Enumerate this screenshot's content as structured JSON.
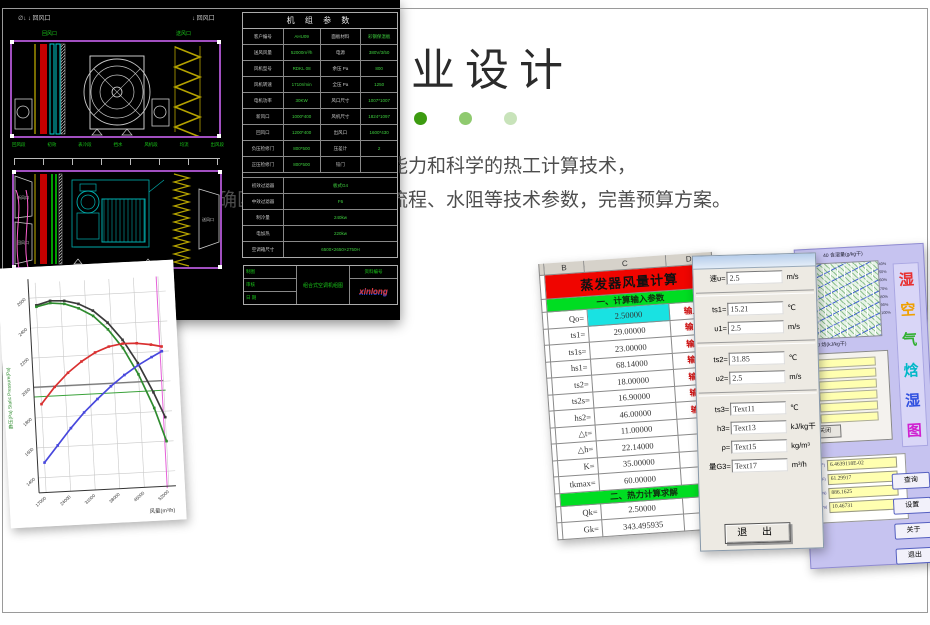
{
  "header": {
    "title": "专业设计",
    "subtitle_line1": "专业的设计能力和科学的热工计算技术，",
    "subtitle_line2": "准确匹配盘管冷热量、流程、水阻等技术参数，完善预算方案。",
    "dot_colors": [
      "#3c9b10",
      "#8fca6f",
      "#c8e3ba"
    ]
  },
  "chart_data": {
    "type": "line",
    "xlabel": "风量(m³/h)",
    "ylabel": "静压(Pa) Static Pressure(Pa)",
    "xlim": [
      15000,
      54000
    ],
    "ylim": [
      1300,
      2700
    ],
    "x_ticks": [
      17000,
      24000,
      31000,
      38000,
      45000,
      52000
    ],
    "y_ticks": [
      1400,
      1600,
      1800,
      2000,
      2200,
      2400,
      2600
    ],
    "x": [
      17000,
      21000,
      25000,
      29000,
      33000,
      37000,
      41000,
      45000,
      49000,
      52000
    ],
    "series": [
      {
        "name": "total-pressure-black",
        "color": "#3a3a3a",
        "values": [
          2550,
          2575,
          2570,
          2545,
          2495,
          2410,
          2290,
          2130,
          1930,
          1760
        ]
      },
      {
        "name": "static-pressure-green",
        "color": "#2e8b2e",
        "values": [
          2540,
          2560,
          2550,
          2515,
          2460,
          2365,
          2235,
          2055,
          1825,
          1600
        ]
      },
      {
        "name": "curve-red",
        "color": "#d93030",
        "values": [
          1890,
          2000,
          2090,
          2160,
          2215,
          2250,
          2265,
          2262,
          2248,
          2232
        ]
      },
      {
        "name": "curve-blue",
        "color": "#4848dd",
        "values": [
          1500,
          1610,
          1720,
          1820,
          1905,
          1985,
          2055,
          2115,
          2165,
          2200
        ]
      }
    ],
    "ref_lines": {
      "gray_y": 2005,
      "green_y": 1940,
      "magenta_x": 51500
    },
    "grid": true,
    "legend": false
  },
  "cad": {
    "top_marks": [
      "∅↓ ↓ 回风口",
      "↓ 回风口"
    ],
    "top_green_labels": [
      "回风口",
      "送风口"
    ],
    "mid_section_labels": [
      "回风段",
      "初效",
      "表冷段",
      "挡水",
      "风机段",
      "均流",
      "出风段"
    ],
    "bottom_section_labels": [
      "表冷挡水段",
      "中效过滤段"
    ],
    "lower_port_labels": {
      "left_top": "新风口",
      "left_bottom": "回风口",
      "right": "送风口"
    },
    "table": {
      "title": "机 组 参 数",
      "rows": [
        [
          "客户编号",
          "AHU09",
          "面板材料",
          "彩钢保温板"
        ],
        [
          "送风风量",
          "52000m³/h",
          "电源",
          "380V/3/50"
        ],
        [
          "风机型号",
          "RDKL 08",
          "余压 Pa",
          "800"
        ],
        [
          "风机转速",
          "1710r/min",
          "全压 Pa",
          "1250"
        ],
        [
          "电机功率",
          "30KW",
          "风口尺寸",
          "1007*1007"
        ],
        [
          "新风口",
          "1000*400",
          "风机尺寸",
          "1824*1097"
        ],
        [
          "回风口",
          "1200*400",
          "出风口",
          "1600*430"
        ],
        [
          "负压检修门",
          "800*500",
          "压差计",
          "2"
        ],
        [
          "正压检修门",
          "800*500",
          "铰门",
          ""
        ],
        [
          "初效过滤器",
          "板式G4"
        ],
        [
          "中效过滤器",
          "F6"
        ],
        [
          "制冷量",
          "240kw"
        ],
        [
          "电加热",
          "220kw"
        ],
        [
          "空调箱尺寸",
          "6500×2650×2750H"
        ]
      ]
    },
    "titleblock": {
      "small_cells": [
        "制图",
        "审核",
        "日 期"
      ],
      "center": "组合式空调机组图",
      "top_right": "资料编号",
      "logo": "xinlong"
    }
  },
  "excel": {
    "cols": [
      "B",
      "C",
      "D"
    ],
    "title": "蒸发器风量计算",
    "section1": "一、计算输入参数",
    "section2": "二、热力计算求解",
    "input_label": "输入",
    "rows1": [
      {
        "label": "Qo=",
        "value": "2.50000",
        "input": true,
        "highlight": true
      },
      {
        "label": "ts1=",
        "value": "29.00000",
        "input": true
      },
      {
        "label": "ts1s=",
        "value": "23.00000",
        "input": true
      },
      {
        "label": "hs1=",
        "value": "68.14000",
        "input": true
      },
      {
        "label": "ts2=",
        "value": "18.00000",
        "input": true
      },
      {
        "label": "ts2s=",
        "value": "16.90000",
        "input": true
      },
      {
        "label": "hs2=",
        "value": "46.00000",
        "input": true
      },
      {
        "label": "△t=",
        "value": "11.00000"
      },
      {
        "label": "△h=",
        "value": "22.14000"
      },
      {
        "label": "K=",
        "value": "35.00000"
      },
      {
        "label": "tkmax=",
        "value": "60.00000"
      }
    ],
    "rows2": [
      {
        "label": "Qk=",
        "value": "2.50000"
      },
      {
        "label": "Gk=",
        "value": "343.495935"
      }
    ]
  },
  "dialog": {
    "fields": [
      {
        "label": "速υ=",
        "value": "2.5",
        "unit": "m/s"
      },
      {
        "label": "ts1=",
        "value": "15.21",
        "unit": "℃"
      },
      {
        "label": "υ1=",
        "value": "2.5",
        "unit": "m/s"
      },
      {
        "label": "ts2=",
        "value": "31.85",
        "unit": "℃"
      },
      {
        "label": "υ2=",
        "value": "2.5",
        "unit": "m/s"
      },
      {
        "label": "ts3=",
        "value": "Text11",
        "unit": "℃"
      },
      {
        "label": "h3=",
        "value": "Text13",
        "unit": "kJ/kg干"
      },
      {
        "label": "ρ=",
        "value": "Text15",
        "unit": "kg/m³"
      },
      {
        "label": "量G3=",
        "value": "Text17",
        "unit": "m³/h"
      }
    ],
    "sep_after": [
      0,
      2,
      4
    ],
    "exit_button": "退 出"
  },
  "lavender": {
    "top_label": "40      含湿量(g/kg干)",
    "bottom_label": "140    焓(kJ/kg干)",
    "rh_labels": [
      "40%",
      "50%",
      "60%",
      "70%",
      "80%",
      "90%",
      "100%"
    ],
    "vertical_title": [
      "湿",
      "空",
      "气",
      "焓",
      "湿",
      "图"
    ],
    "vertical_title_colors": [
      "#e83030",
      "#f0a000",
      "#30b030",
      "#00b8c8",
      "#3050e0",
      "#d020d0"
    ],
    "yellow_row_count": 6,
    "close_button": "关闭",
    "result_labels": [
      "干)",
      "F)",
      "N)",
      "Pa)"
    ],
    "result_values": [
      "6.4639118E-02",
      "61.29917",
      "886.1625",
      "10.46731"
    ],
    "buttons": [
      "查询",
      "设置",
      "关于",
      "退出"
    ]
  }
}
